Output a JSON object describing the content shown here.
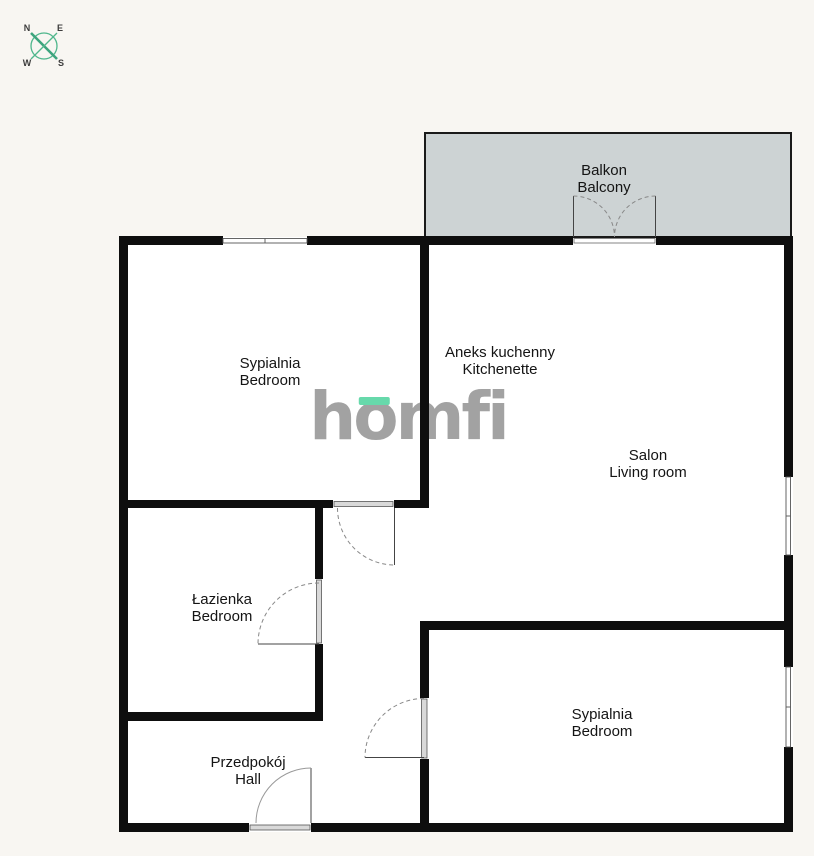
{
  "compass": {
    "n": "N",
    "e": "E",
    "w": "W",
    "s": "S"
  },
  "watermark": {
    "part1": "h",
    "part2": "o",
    "part3": "mfi"
  },
  "colors": {
    "wall": "#0e0e0e",
    "balcony_fill": "#cdd3d4",
    "background": "#f8f6f2",
    "logo_gray": "#a2a2a2",
    "logo_accent": "#67d9ab",
    "compass_green": "#4fb68c"
  },
  "rooms": [
    {
      "id": "balcony",
      "name_pl": "Balkon",
      "name_en": "Balcony"
    },
    {
      "id": "bedroom-top",
      "name_pl": "Sypialnia",
      "name_en": "Bedroom"
    },
    {
      "id": "kitchenette",
      "name_pl": "Aneks kuchenny",
      "name_en": "Kitchenette"
    },
    {
      "id": "living-room",
      "name_pl": "Salon",
      "name_en": "Living room"
    },
    {
      "id": "bathroom",
      "name_pl": "Łazienka",
      "name_en": "Bedroom"
    },
    {
      "id": "hall",
      "name_pl": "Przedpokój",
      "name_en": "Hall"
    },
    {
      "id": "bedroom-bottom",
      "name_pl": "Sypialnia",
      "name_en": "Bedroom"
    }
  ]
}
